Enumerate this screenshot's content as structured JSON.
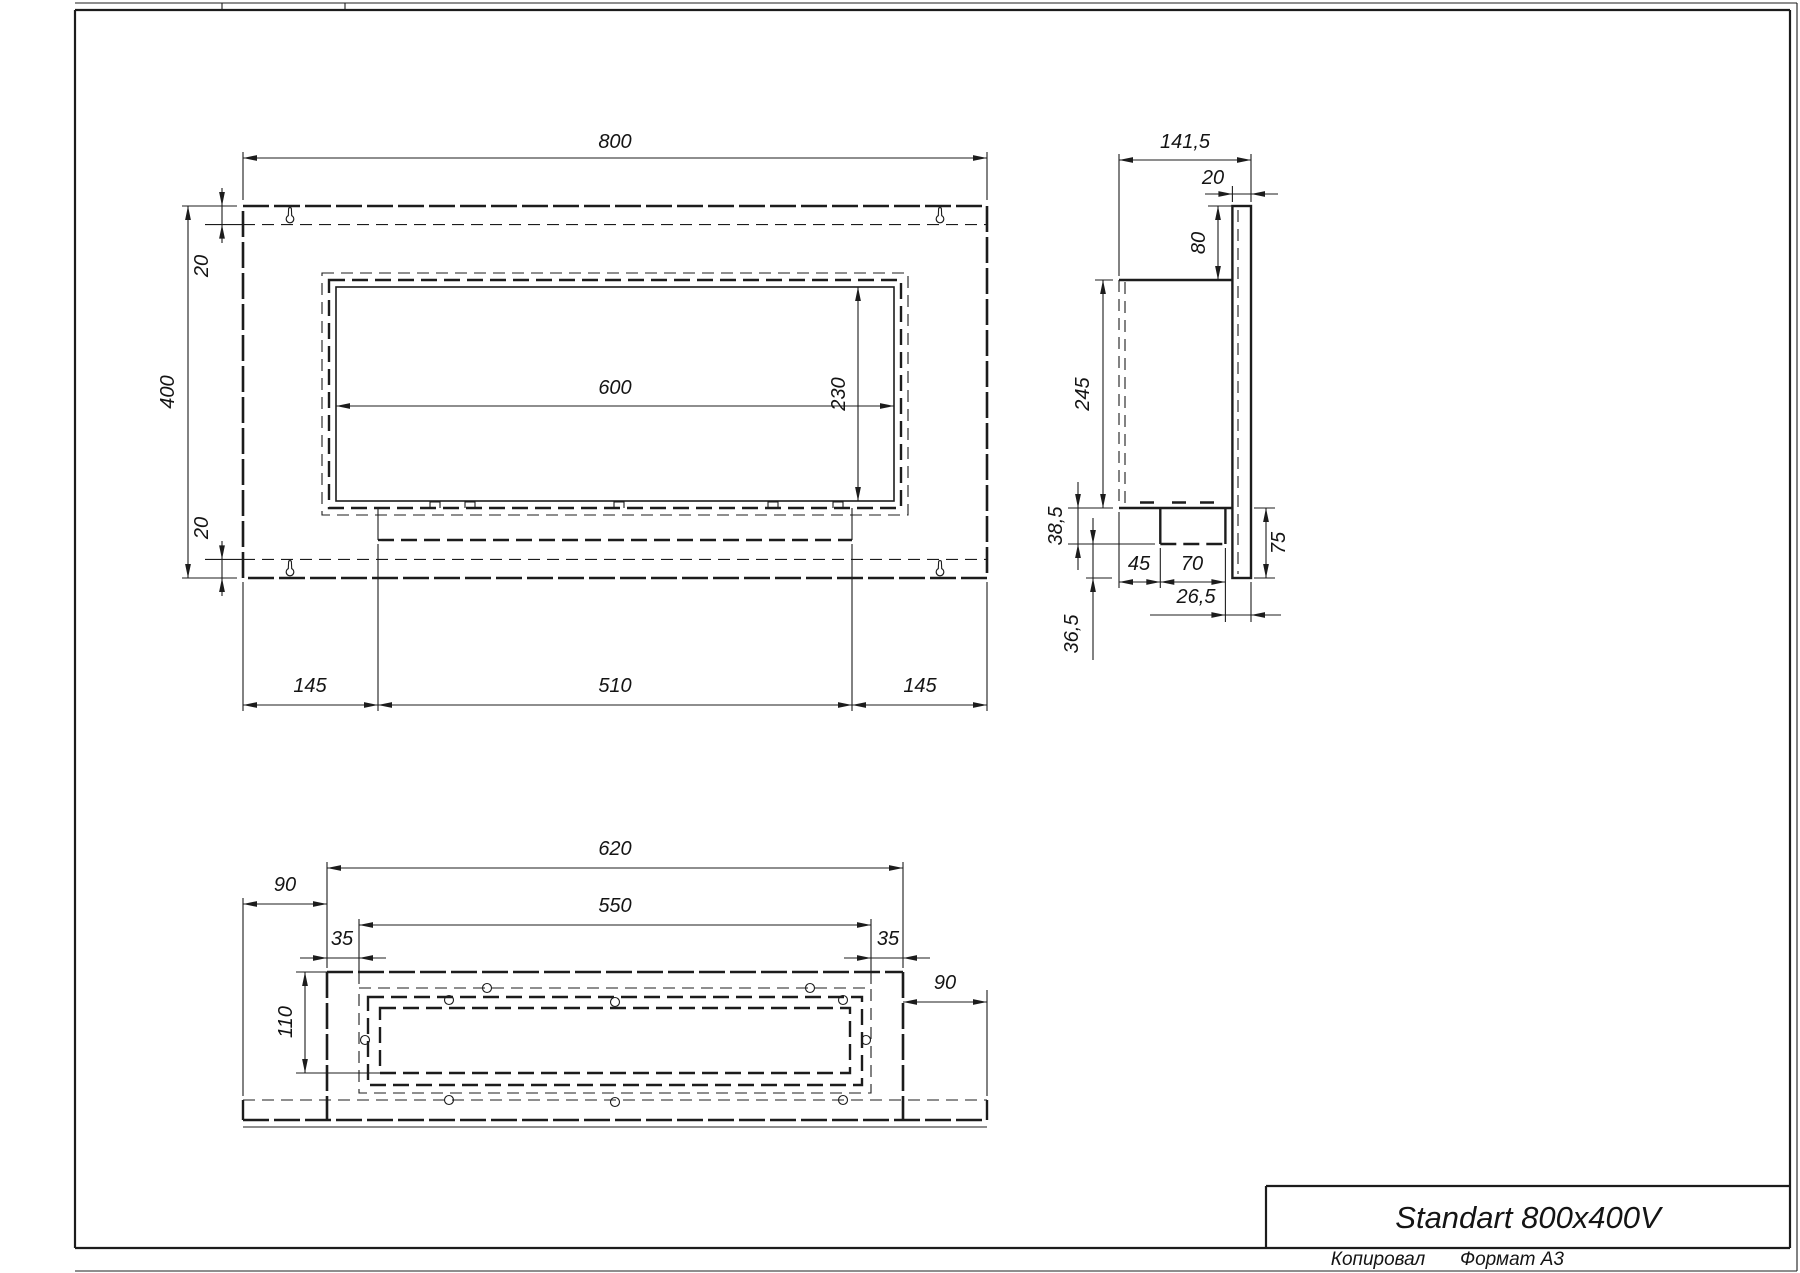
{
  "sheet": {
    "copied_label": "Копировал",
    "format_label": "Формат А3"
  },
  "title_block": {
    "model_name": "Standart 800x400V"
  },
  "front_view": {
    "overall_width": "800",
    "overall_height": "400",
    "top_inset": "20",
    "bottom_inset": "20",
    "opening_width": "600",
    "opening_height": "230",
    "left_margin": "145",
    "burner_width": "510",
    "right_margin": "145"
  },
  "side_view": {
    "overall_depth": "141,5",
    "plate_thickness": "20",
    "top_offset": "80",
    "box_height": "245",
    "tray_drop": "38,5",
    "tray_front_offset": "45",
    "tray_depth": "70",
    "plate_tail": "75",
    "back_clearance": "26,5",
    "bottom_drop": "36,5"
  },
  "bottom_view": {
    "outer_width": "620",
    "inner_width": "550",
    "left_inset": "35",
    "right_inset": "35",
    "left_overhang": "90",
    "right_overhang": "90",
    "inner_depth": "110"
  }
}
